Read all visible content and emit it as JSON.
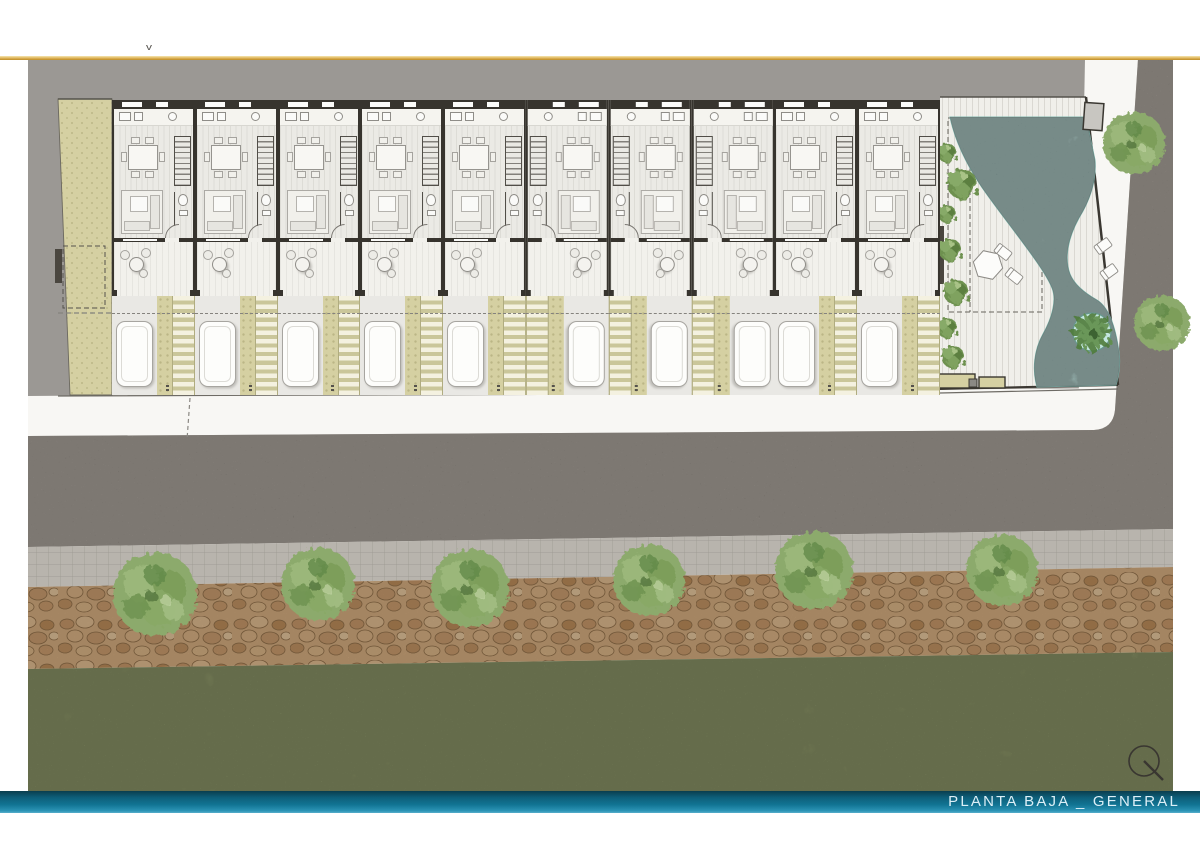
{
  "page": {
    "width": 1200,
    "height": 849
  },
  "header": {
    "stray_mark": "v"
  },
  "footer": {
    "title": "PLANTA BAJA _ GENERAL"
  },
  "plan": {
    "units_count": 10,
    "units": [
      {
        "mirrored": false
      },
      {
        "mirrored": false
      },
      {
        "mirrored": false
      },
      {
        "mirrored": false
      },
      {
        "mirrored": false
      },
      {
        "mirrored": true
      },
      {
        "mirrored": true
      },
      {
        "mirrored": true
      },
      {
        "mirrored": false
      },
      {
        "mirrored": false
      }
    ],
    "street_trees_count": 6,
    "sidewalk_trees_count": 2,
    "features": [
      "townhouse-unit-plans",
      "terraces",
      "driveways-with-cars",
      "pool-deck",
      "free-form-pool",
      "palm-island",
      "sun-loungers",
      "street",
      "paver-sidewalk",
      "stone-mulch-strip",
      "lawn"
    ],
    "palette": {
      "accent_gold": "#D9AE4E",
      "bg_gray": "#9B9894",
      "wall": "#37342E",
      "floor": "#EBEAE5",
      "terrace": "#F2F1EC",
      "khaki": "#D5D0A2",
      "driveway": "#E9E8E4",
      "sidewalk": "#F8F7F4",
      "asphalt": "#8B8278",
      "paver": "#B8B4AD",
      "stone": "#C9A379",
      "grass": "#A7B37D",
      "tree": "#8CAA6C",
      "water": "#ACDDD6",
      "pool_deck": "#F0EFEA",
      "bar_teal": "#117493",
      "title_text": "#DCEFF7"
    }
  },
  "compass": {
    "type": "north-indicator"
  }
}
